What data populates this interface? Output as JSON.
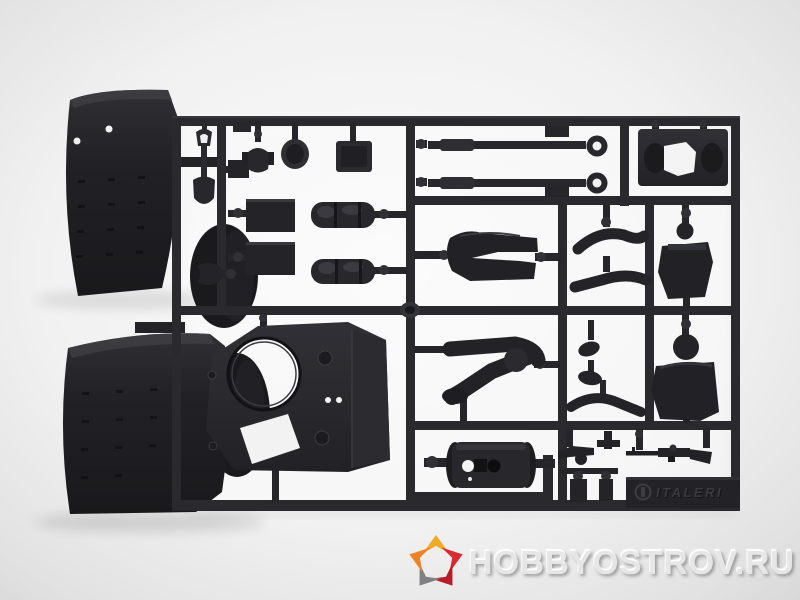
{
  "image": {
    "description": "Product photo of a dark grey injection-molded model-kit sprue (parts tree) with tank accessory parts and crew figures on a light grey backdrop",
    "background_center_color": "#fafafa",
    "background_edge_color": "#d9d9d9",
    "plastic_color": "#26262a",
    "plastic_dark": "#18181b",
    "plastic_light": "#34343a"
  },
  "sprue": {
    "brand_marking": "ITALERI",
    "parts": [
      "fender-top",
      "fender-bottom",
      "shovel",
      "hatch-dome",
      "hatch-round",
      "hatch-rectangular",
      "stowage-box-1",
      "stowage-box-2",
      "tarp-roll-1",
      "tarp-roll-2",
      "muffler",
      "bracket",
      "gun-barrel-1",
      "gun-barrel-2",
      "mantlet-plate",
      "turret-roof",
      "figure-legs-standing",
      "figure-legs-seated",
      "figure-torso-1",
      "figure-torso-2",
      "figure-arm-1",
      "figure-arm-2",
      "figure-hand-1",
      "figure-hand-2",
      "figure-arm-3",
      "gun-drum",
      "machine-gun",
      "gun-mount",
      "rifle",
      "small-box-1",
      "small-box-2"
    ]
  },
  "watermark": {
    "text": "HobbyOstrov.Ru",
    "text_color": "#e6e6e6",
    "star_colors": {
      "yellow": "#f2a71b",
      "orange": "#ee7d1c",
      "red": "#d92028",
      "dark_red": "#b5121f",
      "gray": "#7c7c80"
    }
  }
}
